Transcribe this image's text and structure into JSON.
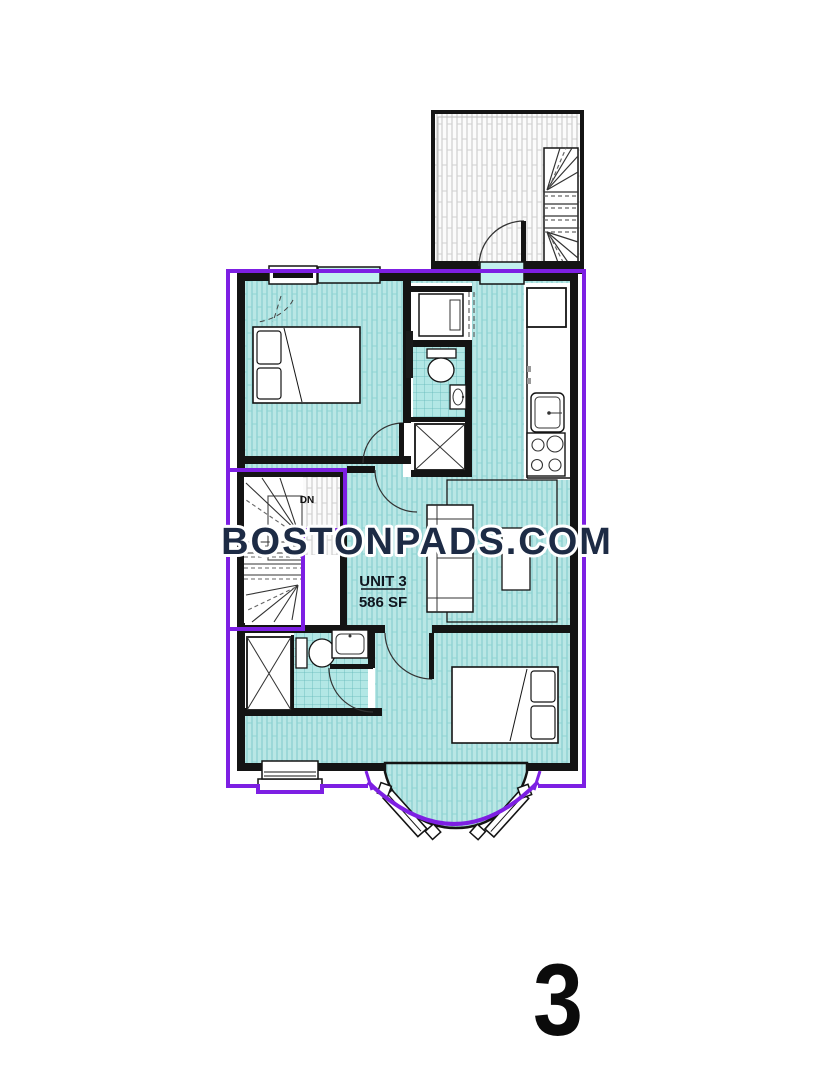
{
  "watermark": {
    "text": "BOSTONPADS.COM",
    "fill": "#1d2b45",
    "halo": "#ffffff"
  },
  "unit_label": {
    "title": "UNIT 3",
    "area": "586 SF"
  },
  "stairs": {
    "direction_label": "DN"
  },
  "floor_badge": {
    "number": "3"
  },
  "colors": {
    "boundary_purple": "#7d1fe3",
    "floor_teal": "#b9e7e5",
    "floor_stripe": "#7ecaca",
    "bath_tile": "#b2e7e5",
    "bath_tile_line": "#62b8b8",
    "wall_black": "#141414",
    "deck_stripe": "#c5c5c5",
    "window_teal": "#c2f0ee"
  },
  "symbols": [
    "bed",
    "pillow",
    "toilet",
    "sink",
    "shower",
    "stove-burners",
    "refrigerator",
    "kitchen-sink",
    "washer-dryer",
    "couch",
    "coffee-table",
    "rug",
    "stairs",
    "door-swing",
    "bay-window",
    "deck"
  ]
}
